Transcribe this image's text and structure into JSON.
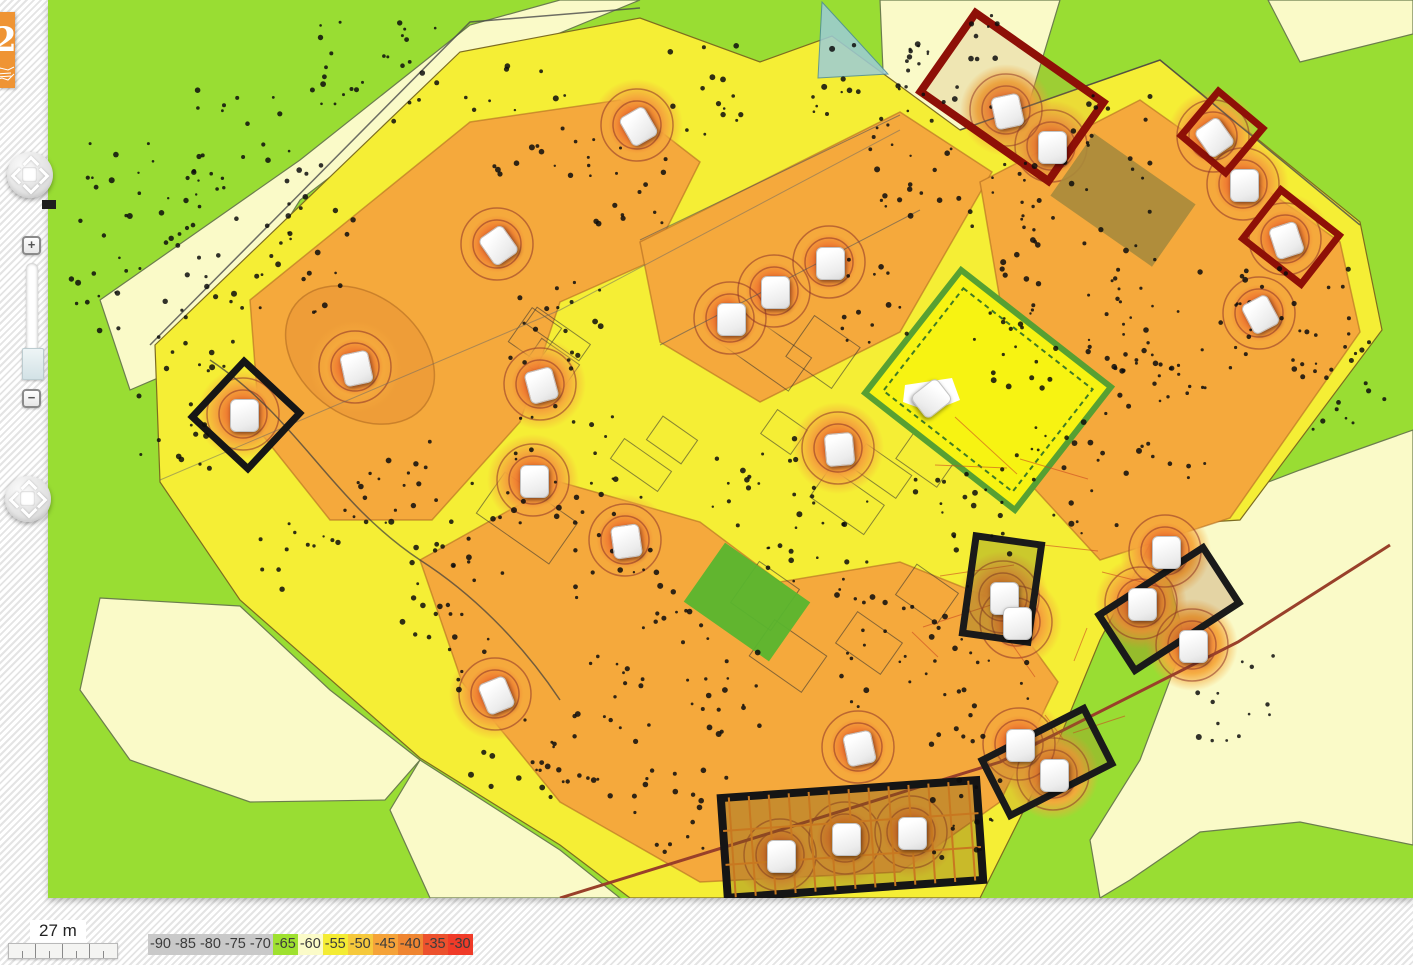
{
  "logo": {
    "glyph": "2"
  },
  "controls": {
    "zoom_in": "+",
    "zoom_out": "−"
  },
  "scale_bar": {
    "label": "27 m"
  },
  "legend": {
    "entries": [
      {
        "label": "-90",
        "color": "#c9c9c9"
      },
      {
        "label": "-85",
        "color": "#c9c9c9"
      },
      {
        "label": "-80",
        "color": "#c9c9c9"
      },
      {
        "label": "-75",
        "color": "#c9c9c9"
      },
      {
        "label": "-70",
        "color": "#c9c9c9"
      },
      {
        "label": "-65",
        "color": "#9fe12f"
      },
      {
        "label": "-60",
        "color": "#fbfbc8"
      },
      {
        "label": "-55",
        "color": "#f4ec33"
      },
      {
        "label": "-50",
        "color": "#f6c93c"
      },
      {
        "label": "-45",
        "color": "#f5a339"
      },
      {
        "label": "-40",
        "color": "#ef8531"
      },
      {
        "label": "-35",
        "color": "#ec512d"
      },
      {
        "label": "-30",
        "color": "#f03b28"
      }
    ]
  },
  "map": {
    "colors": {
      "outside_green": "#99dd33",
      "weak_cream": "#fafac8",
      "medium_yellow": "#f5ee35",
      "strong_orange": "#f5a93c",
      "hotspot_core": "#e8482b",
      "building_outline_black": "#161616",
      "building_outline_red": "#8e1007"
    },
    "access_points": [
      {
        "x": 637,
        "y": 125,
        "rot": -30,
        "hot": true
      },
      {
        "x": 497,
        "y": 244,
        "rot": -35,
        "hot": true
      },
      {
        "x": 355,
        "y": 367,
        "rot": -12,
        "hot": true
      },
      {
        "x": 540,
        "y": 384,
        "rot": -15,
        "hot": true
      },
      {
        "x": 243,
        "y": 414,
        "rot": 0,
        "hot": true
      },
      {
        "x": 533,
        "y": 480,
        "rot": 0,
        "hot": true
      },
      {
        "x": 625,
        "y": 540,
        "rot": -8,
        "hot": true
      },
      {
        "x": 730,
        "y": 318,
        "rot": 0,
        "hot": true
      },
      {
        "x": 774,
        "y": 291,
        "rot": 0,
        "hot": true
      },
      {
        "x": 829,
        "y": 262,
        "rot": 0,
        "hot": true
      },
      {
        "x": 838,
        "y": 448,
        "rot": -5,
        "hot": true
      },
      {
        "x": 930,
        "y": 397,
        "rot": 52,
        "hot": false
      },
      {
        "x": 1006,
        "y": 110,
        "rot": -12,
        "hot": true
      },
      {
        "x": 1051,
        "y": 146,
        "rot": 0,
        "hot": true
      },
      {
        "x": 1213,
        "y": 136,
        "rot": -35,
        "hot": true
      },
      {
        "x": 1243,
        "y": 184,
        "rot": 0,
        "hot": true
      },
      {
        "x": 1285,
        "y": 239,
        "rot": -18,
        "hot": true
      },
      {
        "x": 1259,
        "y": 313,
        "rot": -28,
        "hot": true
      },
      {
        "x": 1165,
        "y": 551,
        "rot": 0,
        "hot": true
      },
      {
        "x": 1003,
        "y": 597,
        "rot": 0,
        "hot": true
      },
      {
        "x": 1016,
        "y": 622,
        "rot": 0,
        "hot": true
      },
      {
        "x": 1141,
        "y": 603,
        "rot": 0,
        "hot": true
      },
      {
        "x": 1192,
        "y": 645,
        "rot": 0,
        "hot": true
      },
      {
        "x": 495,
        "y": 694,
        "rot": -22,
        "hot": true
      },
      {
        "x": 858,
        "y": 747,
        "rot": -12,
        "hot": true
      },
      {
        "x": 1019,
        "y": 744,
        "rot": 0,
        "hot": true
      },
      {
        "x": 1053,
        "y": 774,
        "rot": 0,
        "hot": true
      },
      {
        "x": 780,
        "y": 855,
        "rot": 0,
        "hot": true
      },
      {
        "x": 845,
        "y": 838,
        "rot": 0,
        "hot": true
      },
      {
        "x": 911,
        "y": 832,
        "rot": 0,
        "hot": true
      }
    ]
  }
}
